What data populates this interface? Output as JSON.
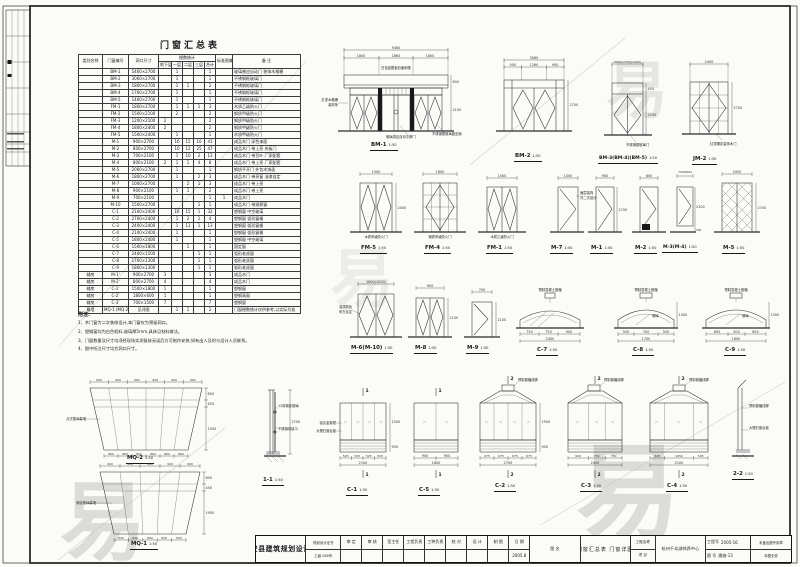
{
  "table": {
    "title": "门窗汇总表",
    "group_header": "樘数统计",
    "col_headers": [
      "类别名称",
      "门窗编号",
      "洞口尺寸",
      "地下层",
      "一层",
      "二层",
      "三层",
      "合计",
      "标准图集",
      "备  注"
    ],
    "rows": [
      [
        "",
        "BM-1",
        "5460×2700",
        "",
        "1",
        "",
        "",
        "1",
        "",
        "玻璃感应自动门 装饰木格栅"
      ],
      [
        "",
        "BM-2",
        "3060×2700",
        "",
        "1",
        "",
        "",
        "1",
        "",
        "不锈钢框玻璃门"
      ],
      [
        "",
        "BM-3",
        "1800×2700",
        "",
        "1",
        "1",
        "",
        "2",
        "",
        "不锈钢框玻璃门"
      ],
      [
        "",
        "BM-4",
        "1700×2700",
        "",
        "1",
        "",
        "",
        "1",
        "",
        "不锈钢框玻璃门"
      ],
      [
        "",
        "BM-5",
        "1400×2700",
        "",
        "1",
        "",
        "",
        "1",
        "",
        "不锈钢框玻璃门"
      ],
      [
        "",
        "FM-1",
        "1800×2700",
        "",
        "1",
        "1",
        "1",
        "3",
        "",
        "木质乙级防火门"
      ],
      [
        "",
        "FM-2",
        "1500×2100",
        "",
        "2",
        "",
        "",
        "2",
        "",
        "钢质甲级防火门"
      ],
      [
        "",
        "FM-3",
        "1200×2100",
        "2",
        "",
        "",
        "",
        "2",
        "",
        "钢质甲级防火门"
      ],
      [
        "",
        "FM-4",
        "1800×2400",
        "2",
        "",
        "",
        "",
        "2",
        "",
        "钢质甲级防火门"
      ],
      [
        "",
        "FM-5",
        "1500×2400",
        "",
        "1",
        "",
        "",
        "1",
        "",
        "木质甲级防火门"
      ],
      [
        "",
        "M-1",
        "900×2700",
        "",
        "16",
        "15",
        "10",
        "41",
        "",
        "成品木门 深色漆面"
      ],
      [
        "",
        "M-2",
        "800×2700",
        "",
        "10",
        "12",
        "25",
        "47",
        "",
        "成品木门 带上亮 夹板门"
      ],
      [
        "",
        "M-3",
        "700×2100",
        "",
        "1",
        "10",
        "2",
        "13",
        "",
        "成品木门 带百叶 厂家配套"
      ],
      [
        "",
        "M-4",
        "800×2100",
        "2",
        "1",
        "1",
        "4",
        "8",
        "",
        "成品木门 带上亮 厂家配套"
      ],
      [
        "",
        "M-5",
        "2000×2700",
        "",
        "1",
        "",
        "",
        "1",
        "",
        "钢质平开门 外包木饰面"
      ],
      [
        "",
        "M-6",
        "1800×2700",
        "",
        "1",
        "",
        "2",
        "3",
        "",
        "成品木门 带亮窗 油漆自定"
      ],
      [
        "",
        "M-7",
        "1000×2700",
        "",
        "",
        "2",
        "1",
        "3",
        "",
        "成品木门 带上亮"
      ],
      [
        "",
        "M-8",
        "900×2100",
        "",
        "1",
        "1",
        "",
        "2",
        "",
        "成品木门 带上亮"
      ],
      [
        "",
        "M-9",
        "700×2100",
        "",
        "",
        "",
        "",
        "1",
        "1",
        "成品木门"
      ],
      [
        "",
        "M-10",
        "1500×2700",
        "",
        "",
        "",
        "1",
        "1",
        "",
        "成品木门 带观察窗"
      ],
      [
        "",
        "C-1",
        "2100×2400",
        "",
        "16",
        "15",
        "1",
        "32",
        "",
        "塑钢窗 中空玻璃"
      ],
      [
        "",
        "C-2",
        "2700×2400",
        "",
        "1",
        "2",
        "1",
        "4",
        "",
        "塑钢窗 弧形窗楣"
      ],
      [
        "",
        "C-3",
        "2400×2400",
        "",
        "1",
        "11",
        "1",
        "13",
        "",
        "塑钢窗 弧形窗楣"
      ],
      [
        "",
        "C-4",
        "2100×2400",
        "",
        "1",
        "",
        "",
        "1",
        "",
        "塑钢窗 弧形窗楣"
      ],
      [
        "",
        "C-5",
        "1800×2400",
        "",
        "1",
        "",
        "",
        "1",
        "",
        "塑钢窗 中空玻璃"
      ],
      [
        "",
        "C-6",
        "1500×1800",
        "",
        "",
        "1",
        "",
        "1",
        "",
        "固定窗"
      ],
      [
        "",
        "C-7",
        "2400×1500",
        "",
        "",
        "",
        "1",
        "1",
        "",
        "弧形老虎窗"
      ],
      [
        "",
        "C-8",
        "1700×1300",
        "",
        "",
        "",
        "1",
        "1",
        "",
        "弧形老虎窗"
      ],
      [
        "",
        "C-9",
        "1800×1300",
        "",
        "",
        "",
        "1",
        "1",
        "",
        "弧形老虎窗"
      ],
      [
        "辅房",
        "M-1'",
        "900×2700",
        "3",
        "",
        "",
        "",
        "3",
        "",
        "成品木门"
      ],
      [
        "辅房",
        "M-2'",
        "800×2700",
        "4",
        "",
        "",
        "",
        "4",
        "",
        "成品木门"
      ],
      [
        "辅房",
        "C-1'",
        "1500×1800",
        "1",
        "",
        "",
        "",
        "1",
        "",
        "塑钢窗"
      ],
      [
        "辅房",
        "C-2'",
        "1800×600",
        "1",
        "",
        "",
        "",
        "1",
        "",
        "塑钢高窗"
      ],
      [
        "辅房",
        "C-3'",
        "700×1500",
        "7",
        "",
        "",
        "",
        "7",
        "",
        "塑钢窗"
      ],
      [
        "幕墙",
        "MQ-1 (MQ-2)",
        "见详图",
        "",
        "1",
        "1",
        "",
        "2",
        "",
        "门窗樘数统计仅供参考,以实际为准"
      ]
    ]
  },
  "notes": {
    "heading": "附注:",
    "items": [
      "1、木门窗为二次装修设计,本门窗仅为预留洞口。",
      "2、塑钢窗均为白色框料,玻璃厚5mm,具体见材料做法。",
      "3、门窗数量及尺寸均须经现场实测复核无误后方可制作安装,如有出入及时与设计人员联系。",
      "4、图中所注尺寸均为洞口尺寸。"
    ]
  },
  "figures": {
    "f1": {
      "name": "BM-1",
      "scale": "1:50",
      "dim_total": "5460",
      "d1": "1800",
      "d2": "1860",
      "d3": "1800",
      "h1": "600",
      "h2": "2100",
      "note_top": "白色铝塑板包面雨篷",
      "note_left1": "红漆木格栅",
      "note_left2": "装饰条",
      "note_b1": "玻璃感应自动平移门",
      "note_b2": "不锈钢框玻璃固定扇"
    },
    "f2": {
      "name": "BM-2",
      "scale": "1:50",
      "dim_total": "3060",
      "d1": "900",
      "d2": "1260",
      "d3": "900",
      "h1": "2700"
    },
    "f3": {
      "name": "BM-3(BM-4)(BM-5)",
      "scale": "1:50",
      "dim_total": "1800(1700)(1400)",
      "h1": "450",
      "h2": "2250",
      "note_b": "不锈钢框玻璃门"
    },
    "f4": {
      "name": "JM-2",
      "scale": "1:50",
      "dim_total": "2400",
      "h1": "2700",
      "note_b": "红漆雕花装饰木门"
    },
    "f5": {
      "name": "FM-5",
      "scale": "1:50",
      "dim_total": "1500",
      "h1": "2400",
      "note": "木质甲级防火门"
    },
    "f6": {
      "name": "FM-4",
      "scale": "1:50",
      "dim_total": "1800",
      "note": "钢质甲级防火门"
    },
    "f7": {
      "name": "FM-1",
      "scale": "1:50",
      "dim_total": "1500",
      "note": "木质乙级防火门"
    },
    "f8": {
      "name": "M-7",
      "scale": "1:50",
      "dim_total": "1000",
      "note1": "面层装饰",
      "note2": "详二次设计"
    },
    "f9": {
      "name": "M-1",
      "scale": "1:50",
      "dim_total": "900",
      "h1": "2700"
    },
    "f10": {
      "name": "M-2",
      "scale": "1:50",
      "dim_total": "800"
    },
    "f11": {
      "name": "M-3(M-4)",
      "scale": "1:50",
      "dim_total": "700(800)",
      "h1": "2100",
      "h2": "300"
    },
    "f12": {
      "name": "M-5",
      "scale": "1:50",
      "dim_total": "2000",
      "h1": "2700"
    },
    "f13": {
      "name": "M-6(M-10)",
      "scale": "1:50",
      "dim_total": "1800(1500)",
      "note1": "油漆颜色",
      "note2": "甲方自定"
    },
    "f14": {
      "name": "M-8",
      "scale": "1:50",
      "dim_total": "900",
      "h1": "2100"
    },
    "f15": {
      "name": "M-9",
      "scale": "1:50",
      "dim_total": "700",
      "h1": "2100"
    },
    "f16": {
      "name": "C-7",
      "scale": "1:50",
      "d1": "750",
      "d2": "750",
      "d3": "900",
      "dim_total": "2400",
      "note_top": "预制混凝土窗楣"
    },
    "f17": {
      "name": "C-8",
      "scale": "1:50",
      "d1": "500",
      "d2": "700",
      "d3": "500",
      "dim_total": "1700",
      "h1": "1300",
      "note_top": "预制混凝土窗楣",
      "glass": "玻璃"
    },
    "f18": {
      "name": "C-9",
      "scale": "1:50",
      "d1": "650",
      "d2": "500",
      "d3": "650",
      "dim_total": "1800",
      "h1": "1300",
      "note_top": "预制混凝土窗楣",
      "glass": "玻璃"
    },
    "f19": {
      "name": "MQ-2",
      "scale": "1:50",
      "cell_dim": "900",
      "cell_dim_b": "860",
      "h1": "600",
      "h2": "450",
      "h3": "1950",
      "note": "点式玻璃幕墙"
    },
    "f20": {
      "name": "MQ-1",
      "scale": "1:50",
      "cell_dim": "900",
      "cell_dim_b": "840",
      "h1": "600",
      "h2": "450",
      "h3": "1950",
      "note": "钢化玻璃幕墙"
    },
    "f21": {
      "name": "1-1",
      "scale": "1:50",
      "h1": "2700",
      "note1": "12厚钢化玻璃",
      "note2": "不锈钢驳接爪"
    },
    "f22": {
      "name": "C-1",
      "scale": "1:50",
      "cell_dim": "525",
      "dim_total": "2100",
      "h1": "1500",
      "h2": "900",
      "note1": "铝合金窗框",
      "note2": "大理石窗台板",
      "mark": "1"
    },
    "f23": {
      "name": "C-5",
      "scale": "1:50",
      "cell_dim": "900",
      "dim_total": "1800",
      "mark": "1"
    },
    "f24": {
      "name": "C-2",
      "scale": "1:50",
      "cell_dim": "675",
      "dim_total": "2700",
      "h1": "1500",
      "h2": "900",
      "note": "预制窗楣线脚",
      "mark": "2"
    },
    "f25": {
      "name": "C-3",
      "scale": "1:50",
      "d1": "900",
      "d2": "750",
      "d3": "750",
      "dim_total": "2400",
      "note": "预制窗楣线脚",
      "mark": "2"
    },
    "f26": {
      "name": "C-4",
      "scale": "1:50",
      "d1": "525",
      "d2": "1050",
      "d3": "525",
      "dim_total": "2100",
      "note": "预制窗楣线脚",
      "mark": "2"
    },
    "f27": {
      "name": "2-2",
      "scale": "1:50",
      "note1": "预制窗楣线脚",
      "note2": "大理石窗台板"
    }
  },
  "titleblock": {
    "company": "淳安县建筑规划设计所",
    "cert_line1": "规划设计证书",
    "cert_line2": "乙级 048号",
    "sign_labels": [
      "审 定",
      "审 核",
      "室主任",
      "工程负责",
      "工种负责",
      "校 对",
      "设 计",
      "制 图",
      "日 期"
    ],
    "date": "2005.8",
    "drawing_title_label": "图 名",
    "drawing_title": "门窗汇总表  门窗详图",
    "project_label_1": "工程名称",
    "project_label_2": "项  目",
    "project_name": "杭州千岛湖休养中心",
    "job_no_label": "工程号",
    "job_no": "2005-16",
    "sheet_no_label": "图 号",
    "sheet_no": "建施-13",
    "stamp_line1": "未盖出图专用章",
    "stamp_line2": "本图无效"
  },
  "watermark": {
    "char": "易"
  }
}
